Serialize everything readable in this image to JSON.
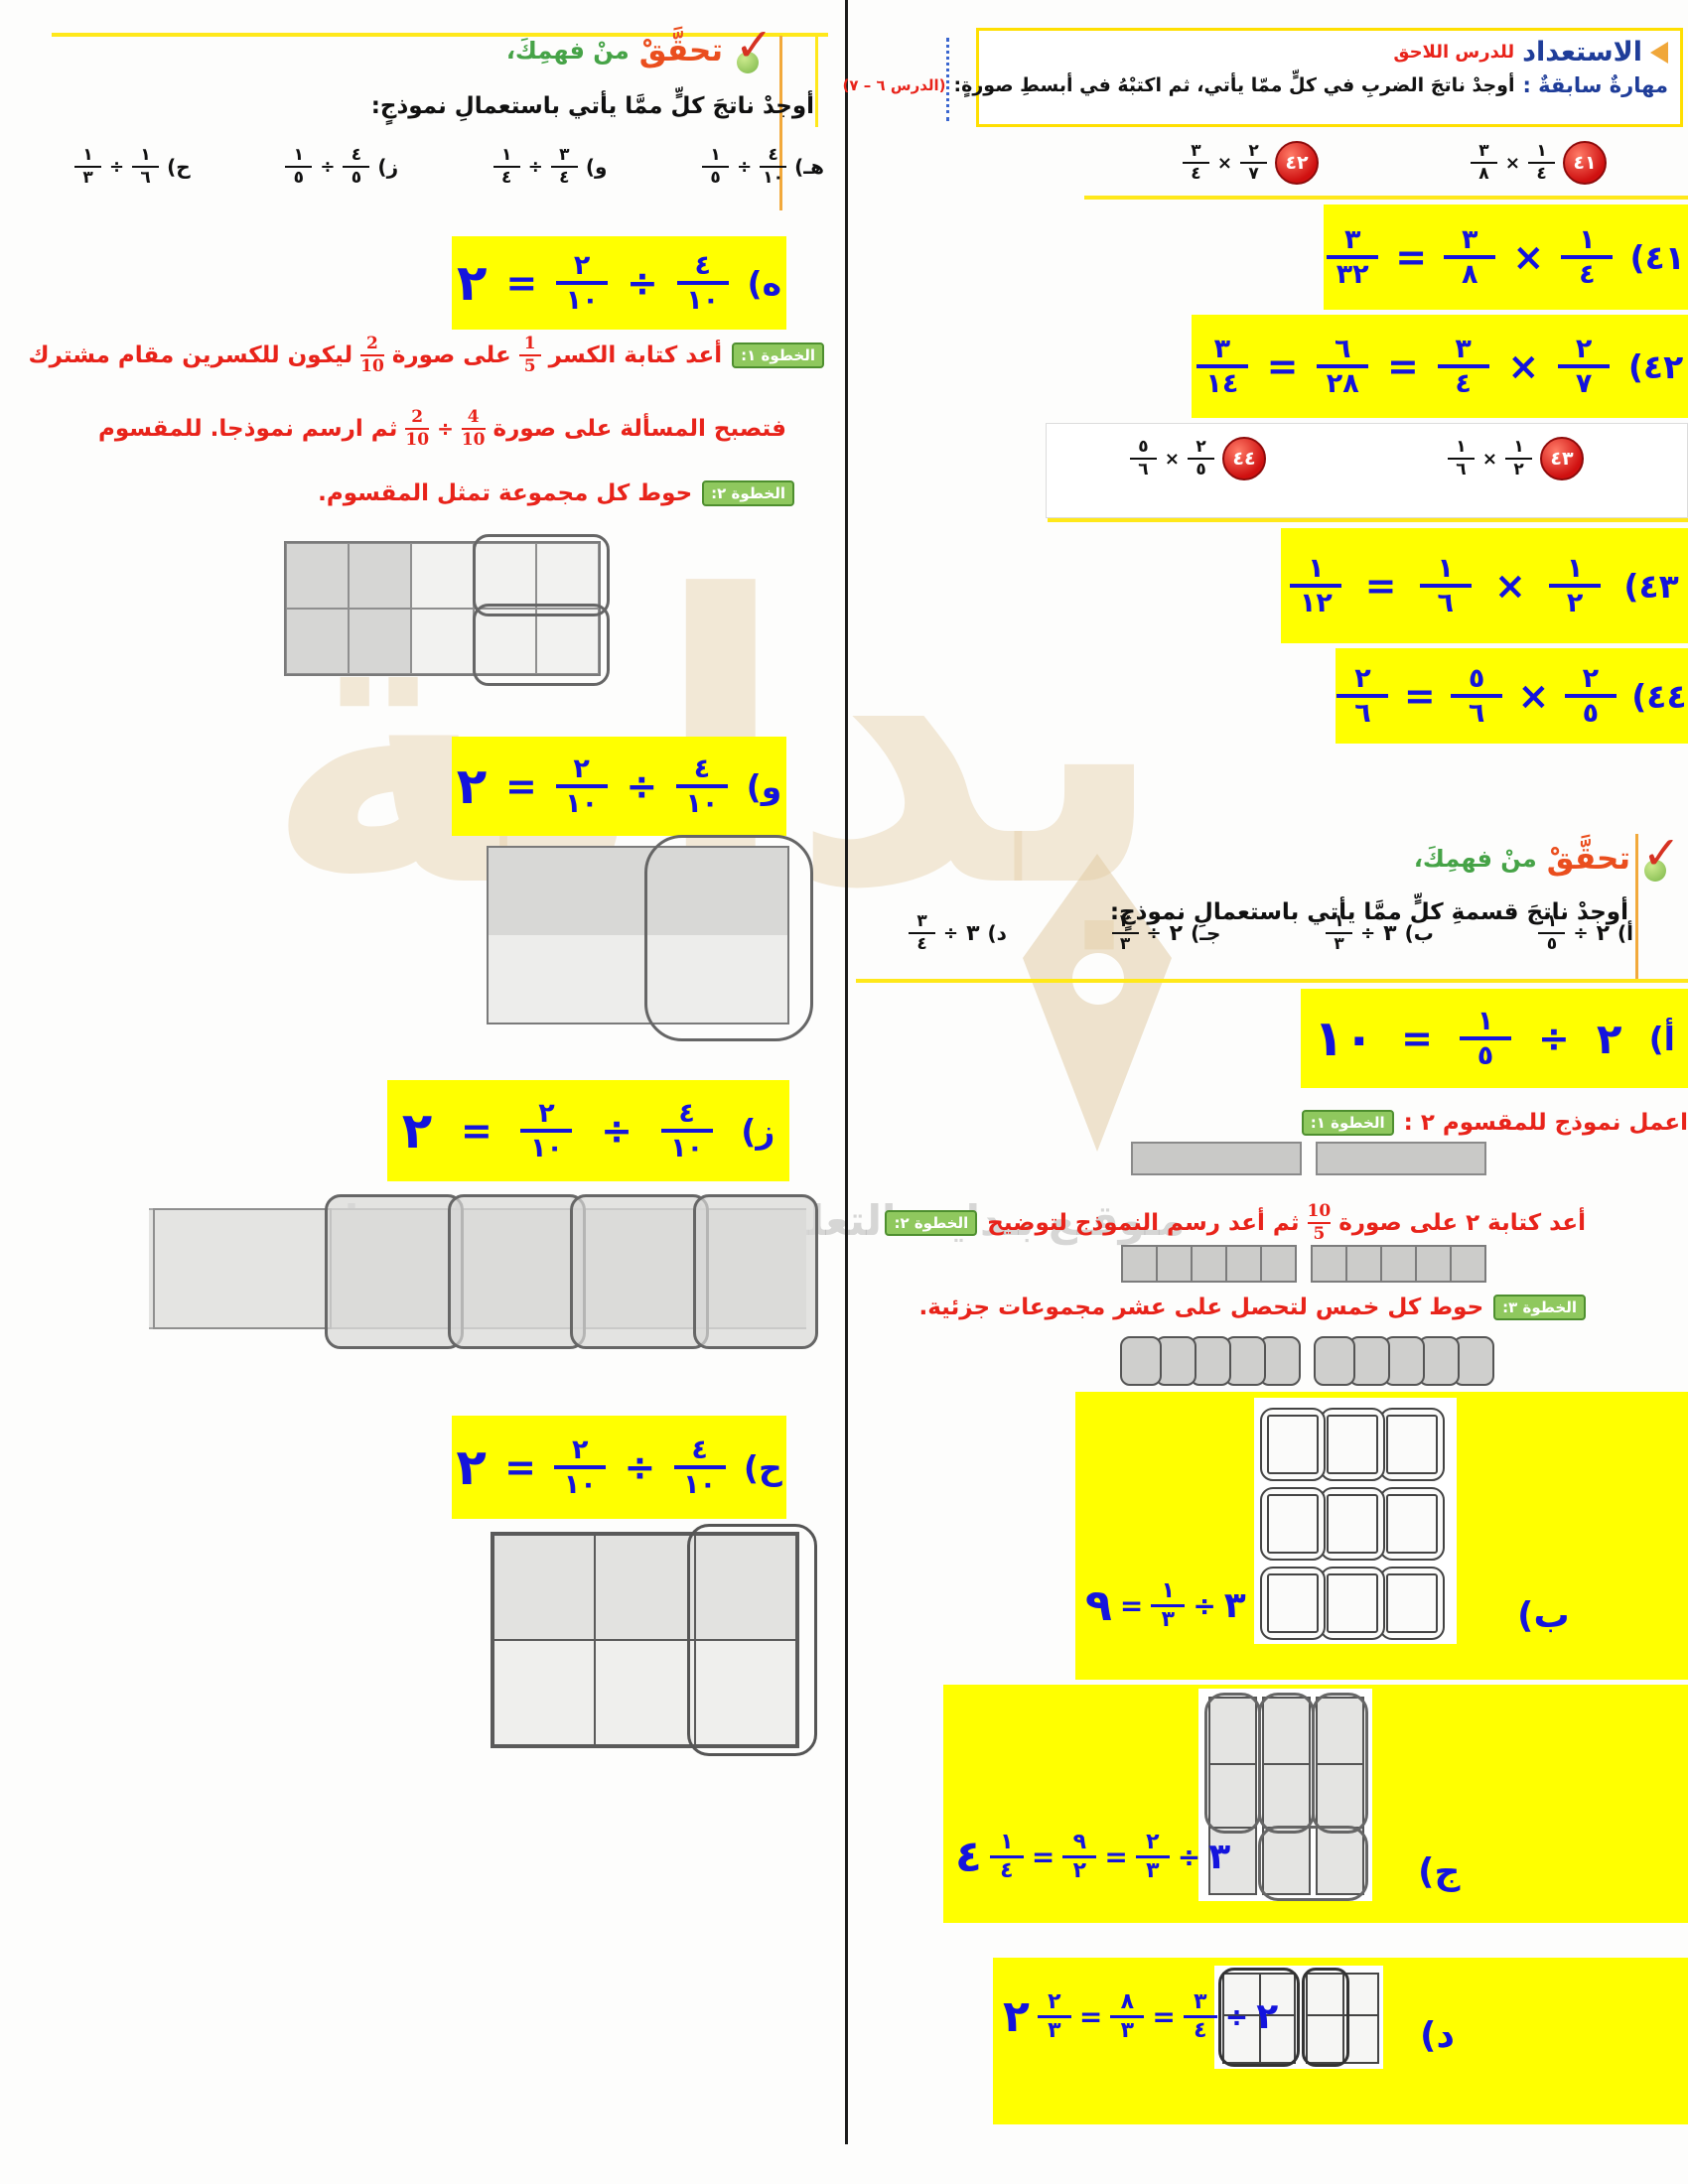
{
  "watermark": {
    "big_word": "بداية",
    "caption": "مـوقـع بـدايـة التعليمي | beadaya.com"
  },
  "right": {
    "prep": {
      "title_main": "الاستعداد",
      "title_sub": "للدرس اللاحق",
      "skill_label": "مهارةٌ سابقةٌ :",
      "skill_text": "أوجدْ ناتجَ الضربِ في كلٍّ ممّا يأتي، ثم اكتبْهُ في أبسطِ صورةٍ:",
      "lesson_ref": "(الدرس ٦ – ٧)"
    },
    "p41": {
      "badge": "٤١",
      "eq": [
        {
          "t": "f",
          "n": "١",
          "d": "٤"
        },
        {
          "t": "o",
          "v": "×"
        },
        {
          "t": "f",
          "n": "٣",
          "d": "٨"
        }
      ]
    },
    "p42": {
      "badge": "٤٢",
      "eq": [
        {
          "t": "f",
          "n": "٢",
          "d": "٧"
        },
        {
          "t": "o",
          "v": "×"
        },
        {
          "t": "f",
          "n": "٣",
          "d": "٤"
        }
      ]
    },
    "p43": {
      "badge": "٤٣",
      "eq": [
        {
          "t": "f",
          "n": "١",
          "d": "٢"
        },
        {
          "t": "o",
          "v": "×"
        },
        {
          "t": "f",
          "n": "١",
          "d": "٦"
        }
      ]
    },
    "p44": {
      "badge": "٤٤",
      "eq": [
        {
          "t": "f",
          "n": "٢",
          "d": "٥"
        },
        {
          "t": "o",
          "v": "×"
        },
        {
          "t": "f",
          "n": "٥",
          "d": "٦"
        }
      ]
    },
    "ans41": [
      {
        "t": "lbl",
        "v": "٤١)"
      },
      {
        "t": "f",
        "n": "١",
        "d": "٤"
      },
      {
        "t": "o",
        "v": "×"
      },
      {
        "t": "f",
        "n": "٣",
        "d": "٨"
      },
      {
        "t": "o",
        "v": "="
      },
      {
        "t": "f",
        "n": "٣",
        "d": "٣٢"
      }
    ],
    "ans42": [
      {
        "t": "lbl",
        "v": "٤٢)"
      },
      {
        "t": "f",
        "n": "٢",
        "d": "٧"
      },
      {
        "t": "o",
        "v": "×"
      },
      {
        "t": "f",
        "n": "٣",
        "d": "٤"
      },
      {
        "t": "o",
        "v": "="
      },
      {
        "t": "f",
        "n": "٦",
        "d": "٢٨"
      },
      {
        "t": "o",
        "v": "="
      },
      {
        "t": "f",
        "n": "٣",
        "d": "١٤"
      }
    ],
    "ans43": [
      {
        "t": "lbl",
        "v": "٤٣)"
      },
      {
        "t": "f",
        "n": "١",
        "d": "٢"
      },
      {
        "t": "o",
        "v": "×"
      },
      {
        "t": "f",
        "n": "١",
        "d": "٦"
      },
      {
        "t": "o",
        "v": "="
      },
      {
        "t": "f",
        "n": "١",
        "d": "١٢"
      }
    ],
    "ans44": [
      {
        "t": "lbl",
        "v": "٤٤)"
      },
      {
        "t": "f",
        "n": "٢",
        "d": "٥"
      },
      {
        "t": "o",
        "v": "×"
      },
      {
        "t": "f",
        "n": "٥",
        "d": "٦"
      },
      {
        "t": "o",
        "v": "="
      },
      {
        "t": "f",
        "n": "٢",
        "d": "٦"
      }
    ],
    "check": {
      "head_red": "تحقَّقْ",
      "head_green": "منْ فهمِكَ،",
      "instruction": "أوجدْ ناتجَ قسمةِ كلٍّ ممَّا يأتي باستعمالِ نموذجٍ:",
      "probA": [
        {
          "t": "lbl",
          "v": "أ)"
        },
        {
          "t": "n",
          "v": "٢"
        },
        {
          "t": "o",
          "v": "÷"
        },
        {
          "t": "f",
          "n": "١",
          "d": "٥"
        }
      ],
      "probB": [
        {
          "t": "lbl",
          "v": "ب)"
        },
        {
          "t": "n",
          "v": "٣"
        },
        {
          "t": "o",
          "v": "÷"
        },
        {
          "t": "f",
          "n": "١",
          "d": "٣"
        }
      ],
      "probC": [
        {
          "t": "lbl",
          "v": "جـ)"
        },
        {
          "t": "n",
          "v": "٢"
        },
        {
          "t": "o",
          "v": "÷"
        },
        {
          "t": "f",
          "n": "٢",
          "d": "٣"
        }
      ],
      "probD": [
        {
          "t": "lbl",
          "v": "د)"
        },
        {
          "t": "n",
          "v": "٣"
        },
        {
          "t": "o",
          "v": "÷"
        },
        {
          "t": "f",
          "n": "٣",
          "d": "٤"
        }
      ],
      "ansA": [
        {
          "t": "lbl",
          "v": "أ)"
        },
        {
          "t": "n",
          "v": "٢"
        },
        {
          "t": "o",
          "v": "÷"
        },
        {
          "t": "f",
          "n": "١",
          "d": "٥"
        },
        {
          "t": "o",
          "v": "="
        },
        {
          "t": "nbig",
          "v": "١٠"
        }
      ],
      "steps": [
        {
          "tag": "الخطوة ١:",
          "eq": [
            {
              "t": "txt",
              "v": "اعمل نموذج للمقسوم ٢ :"
            }
          ]
        },
        {
          "tag": "الخطوة ٢:",
          "eq": [
            {
              "t": "txt",
              "v": "أعد كتابة ٢ على صورة"
            },
            {
              "t": "f",
              "n": "10",
              "d": "5"
            },
            {
              "t": "txt",
              "v": "ثم أعد رسم النموذج لتوضيح"
            }
          ]
        },
        {
          "tag": "الخطوة ٣:",
          "eq": [
            {
              "t": "txt",
              "v": "حوط كل خمس لتحصل على عشر مجموعات جزئية."
            }
          ]
        }
      ],
      "lblB": "ب)",
      "ansB": [
        {
          "t": "n",
          "v": "٣"
        },
        {
          "t": "o",
          "v": "÷"
        },
        {
          "t": "f",
          "n": "١",
          "d": "٣"
        },
        {
          "t": "o",
          "v": "="
        },
        {
          "t": "nbig",
          "v": "٩"
        }
      ],
      "lblC": "ج)",
      "ansC": [
        {
          "t": "n",
          "v": "٣"
        },
        {
          "t": "o",
          "v": "÷"
        },
        {
          "t": "f",
          "n": "٢",
          "d": "٣"
        },
        {
          "t": "o",
          "v": "="
        },
        {
          "t": "f",
          "n": "٩",
          "d": "٢"
        },
        {
          "t": "o",
          "v": "="
        },
        {
          "t": "f",
          "n": "١",
          "d": "٤"
        },
        {
          "t": "nbig",
          "v": "٤"
        }
      ],
      "lblD": "د)",
      "ansD": [
        {
          "t": "n",
          "v": "٢"
        },
        {
          "t": "o",
          "v": "÷"
        },
        {
          "t": "f",
          "n": "٣",
          "d": "٤"
        },
        {
          "t": "o",
          "v": "="
        },
        {
          "t": "f",
          "n": "٨",
          "d": "٣"
        },
        {
          "t": "o",
          "v": "="
        },
        {
          "t": "f",
          "n": "٢",
          "d": "٣"
        },
        {
          "t": "nbig",
          "v": "٢"
        }
      ]
    }
  },
  "left": {
    "check": {
      "head_red": "تحقَّقْ",
      "head_green": "منْ فهمِكَ،",
      "instruction": "أوجدْ ناتجَ كلٍّ ممَّا يأتي باستعمالِ نموذجٍ:",
      "probE": [
        {
          "t": "lbl",
          "v": "هـ)"
        },
        {
          "t": "f",
          "n": "٤",
          "d": "١٠"
        },
        {
          "t": "o",
          "v": "÷"
        },
        {
          "t": "f",
          "n": "١",
          "d": "٥"
        }
      ],
      "probF": [
        {
          "t": "lbl",
          "v": "و)"
        },
        {
          "t": "f",
          "n": "٣",
          "d": "٤"
        },
        {
          "t": "o",
          "v": "÷"
        },
        {
          "t": "f",
          "n": "١",
          "d": "٤"
        }
      ],
      "probG": [
        {
          "t": "lbl",
          "v": "ز)"
        },
        {
          "t": "f",
          "n": "٤",
          "d": "٥"
        },
        {
          "t": "o",
          "v": "÷"
        },
        {
          "t": "f",
          "n": "١",
          "d": "٥"
        }
      ],
      "probH": [
        {
          "t": "lbl",
          "v": "ح)"
        },
        {
          "t": "f",
          "n": "١",
          "d": "٦"
        },
        {
          "t": "o",
          "v": "÷"
        },
        {
          "t": "f",
          "n": "١",
          "d": "٣"
        }
      ],
      "ansE": [
        {
          "t": "lbl",
          "v": "ه)"
        },
        {
          "t": "f",
          "n": "٤",
          "d": "١٠"
        },
        {
          "t": "o",
          "v": "÷"
        },
        {
          "t": "f",
          "n": "٢",
          "d": "١٠"
        },
        {
          "t": "o",
          "v": "="
        },
        {
          "t": "nbig",
          "v": "٢"
        }
      ],
      "ansF": [
        {
          "t": "lbl",
          "v": "و)"
        },
        {
          "t": "f",
          "n": "٤",
          "d": "١٠"
        },
        {
          "t": "o",
          "v": "÷"
        },
        {
          "t": "f",
          "n": "٢",
          "d": "١٠"
        },
        {
          "t": "o",
          "v": "="
        },
        {
          "t": "nbig",
          "v": "٢"
        }
      ],
      "ansG": [
        {
          "t": "lbl",
          "v": "ز)"
        },
        {
          "t": "f",
          "n": "٤",
          "d": "١٠"
        },
        {
          "t": "o",
          "v": "÷"
        },
        {
          "t": "f",
          "n": "٢",
          "d": "١٠"
        },
        {
          "t": "o",
          "v": "="
        },
        {
          "t": "nbig",
          "v": "٢"
        }
      ],
      "ansH": [
        {
          "t": "lbl",
          "v": "ح)"
        },
        {
          "t": "f",
          "n": "٤",
          "d": "١٠"
        },
        {
          "t": "o",
          "v": "÷"
        },
        {
          "t": "f",
          "n": "٢",
          "d": "١٠"
        },
        {
          "t": "o",
          "v": "="
        },
        {
          "t": "nbig",
          "v": "٢"
        }
      ],
      "steps": [
        {
          "tag": "الخطوة ١:",
          "eq": [
            {
              "t": "txt",
              "v": "أعد كتابة الكسر"
            },
            {
              "t": "f",
              "n": "1",
              "d": "5"
            },
            {
              "t": "txt",
              "v": "على صورة"
            },
            {
              "t": "f",
              "n": "2",
              "d": "10"
            },
            {
              "t": "txt",
              "v": "ليكون للكسرين مقام مشترك"
            }
          ]
        },
        {
          "tag": "",
          "eq": [
            {
              "t": "txt",
              "v": "فتصبح المسألة على صورة"
            },
            {
              "t": "f",
              "n": "4",
              "d": "10"
            },
            {
              "t": "o",
              "v": "÷"
            },
            {
              "t": "f",
              "n": "2",
              "d": "10"
            },
            {
              "t": "txt",
              "v": "ثم ارسم نموذجا. للمقسوم"
            }
          ]
        },
        {
          "tag": "الخطوة ٢:",
          "eq": [
            {
              "t": "txt",
              "v": "حوط كل مجموعة تمثل المقسوم."
            }
          ]
        }
      ]
    }
  }
}
